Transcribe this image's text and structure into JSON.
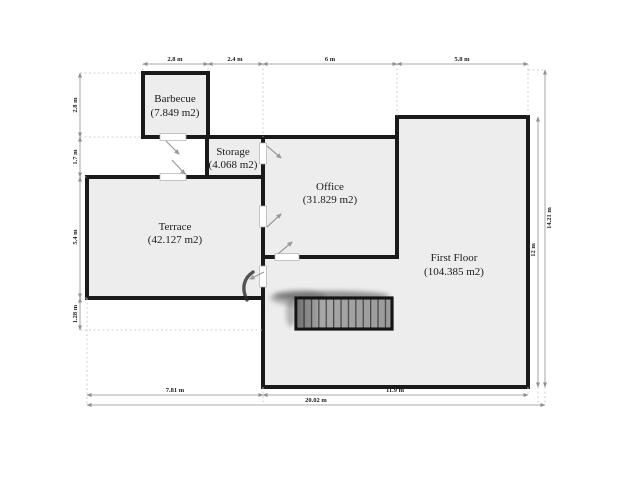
{
  "document": {
    "type": "architectural floor plan",
    "units": "m"
  },
  "rooms": [
    {
      "name": "Barbecue",
      "area": "(7.849 m2)"
    },
    {
      "name": "Storage",
      "area": "(4.068 m2)"
    },
    {
      "name": "Office",
      "area": "(31.829 m2)"
    },
    {
      "name": "Terrace",
      "area": "(42.127 m2)"
    },
    {
      "name": "First Floor",
      "area": "(104.385 m2)"
    }
  ],
  "dimensions": {
    "top": [
      "2.8 m",
      "2.4 m",
      "6 m",
      "5.8 m"
    ],
    "left": [
      "2.8 m",
      "1.7 m",
      "5.4 m",
      "1.28 m"
    ],
    "right": [
      "12 m",
      "14.21 m"
    ],
    "bottom": [
      "7.81 m",
      "11.9 m",
      "20.02 m"
    ]
  },
  "colors": {
    "wall": "#1a1a1a",
    "room_fill": "#ededed",
    "dim_line": "#8f8f8f",
    "extension_line": "#c4c4c4",
    "door_arrow": "#9a9a9a",
    "stairs_fill": "#b0b0b0",
    "background": "#ffffff"
  }
}
